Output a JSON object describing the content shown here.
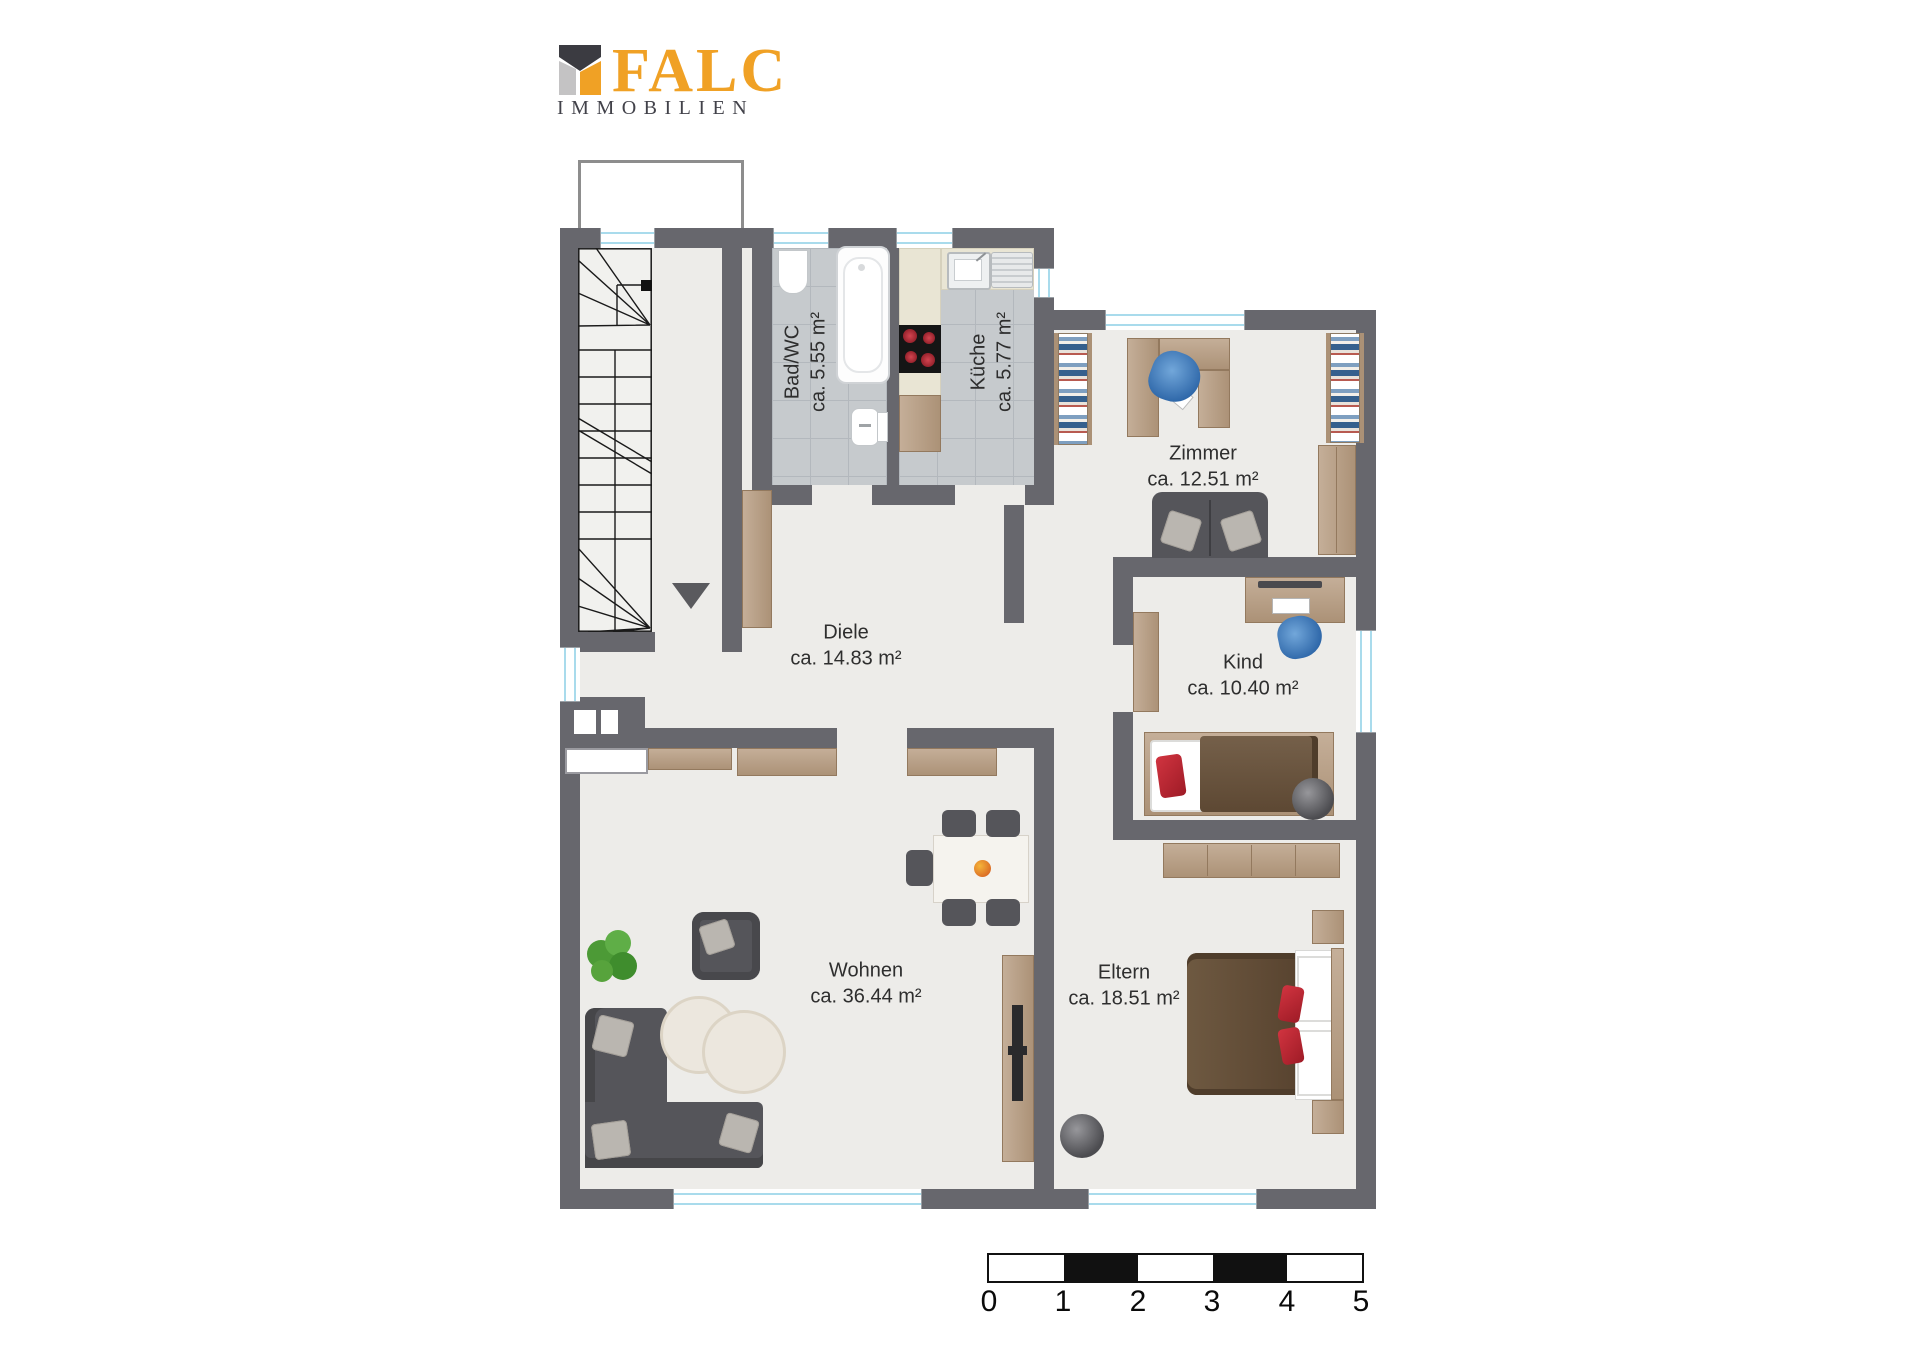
{
  "logo": {
    "brand": "FALC",
    "subtitle": "IMMOBILIEN"
  },
  "rooms": [
    {
      "id": "bad",
      "name": "Bad/WC",
      "area": "ca. 5.55 m²"
    },
    {
      "id": "kueche",
      "name": "Küche",
      "area": "ca. 5.77 m²"
    },
    {
      "id": "zimmer",
      "name": "Zimmer",
      "area": "ca. 12.51 m²"
    },
    {
      "id": "diele",
      "name": "Diele",
      "area": "ca. 14.83 m²"
    },
    {
      "id": "kind",
      "name": "Kind",
      "area": "ca. 10.40 m²"
    },
    {
      "id": "wohnen",
      "name": "Wohnen",
      "area": "ca. 36.44 m²"
    },
    {
      "id": "eltern",
      "name": "Eltern",
      "area": "ca. 18.51 m²"
    }
  ],
  "scale_bar": {
    "unit": "m",
    "ticks": [
      "0",
      "1",
      "2",
      "3",
      "4",
      "5"
    ],
    "segment_colors": [
      "#ffffff",
      "#111111",
      "#ffffff",
      "#111111",
      "#ffffff"
    ]
  },
  "colors": {
    "wall": "#67676d",
    "floor": "#edece9",
    "tile": "#c6cacd",
    "wood": "#b49a83",
    "brand_orange": "#f0a125",
    "brand_gray": "#42424a",
    "accent_red": "#bf2430",
    "accent_blue": "#2f6cb3"
  }
}
